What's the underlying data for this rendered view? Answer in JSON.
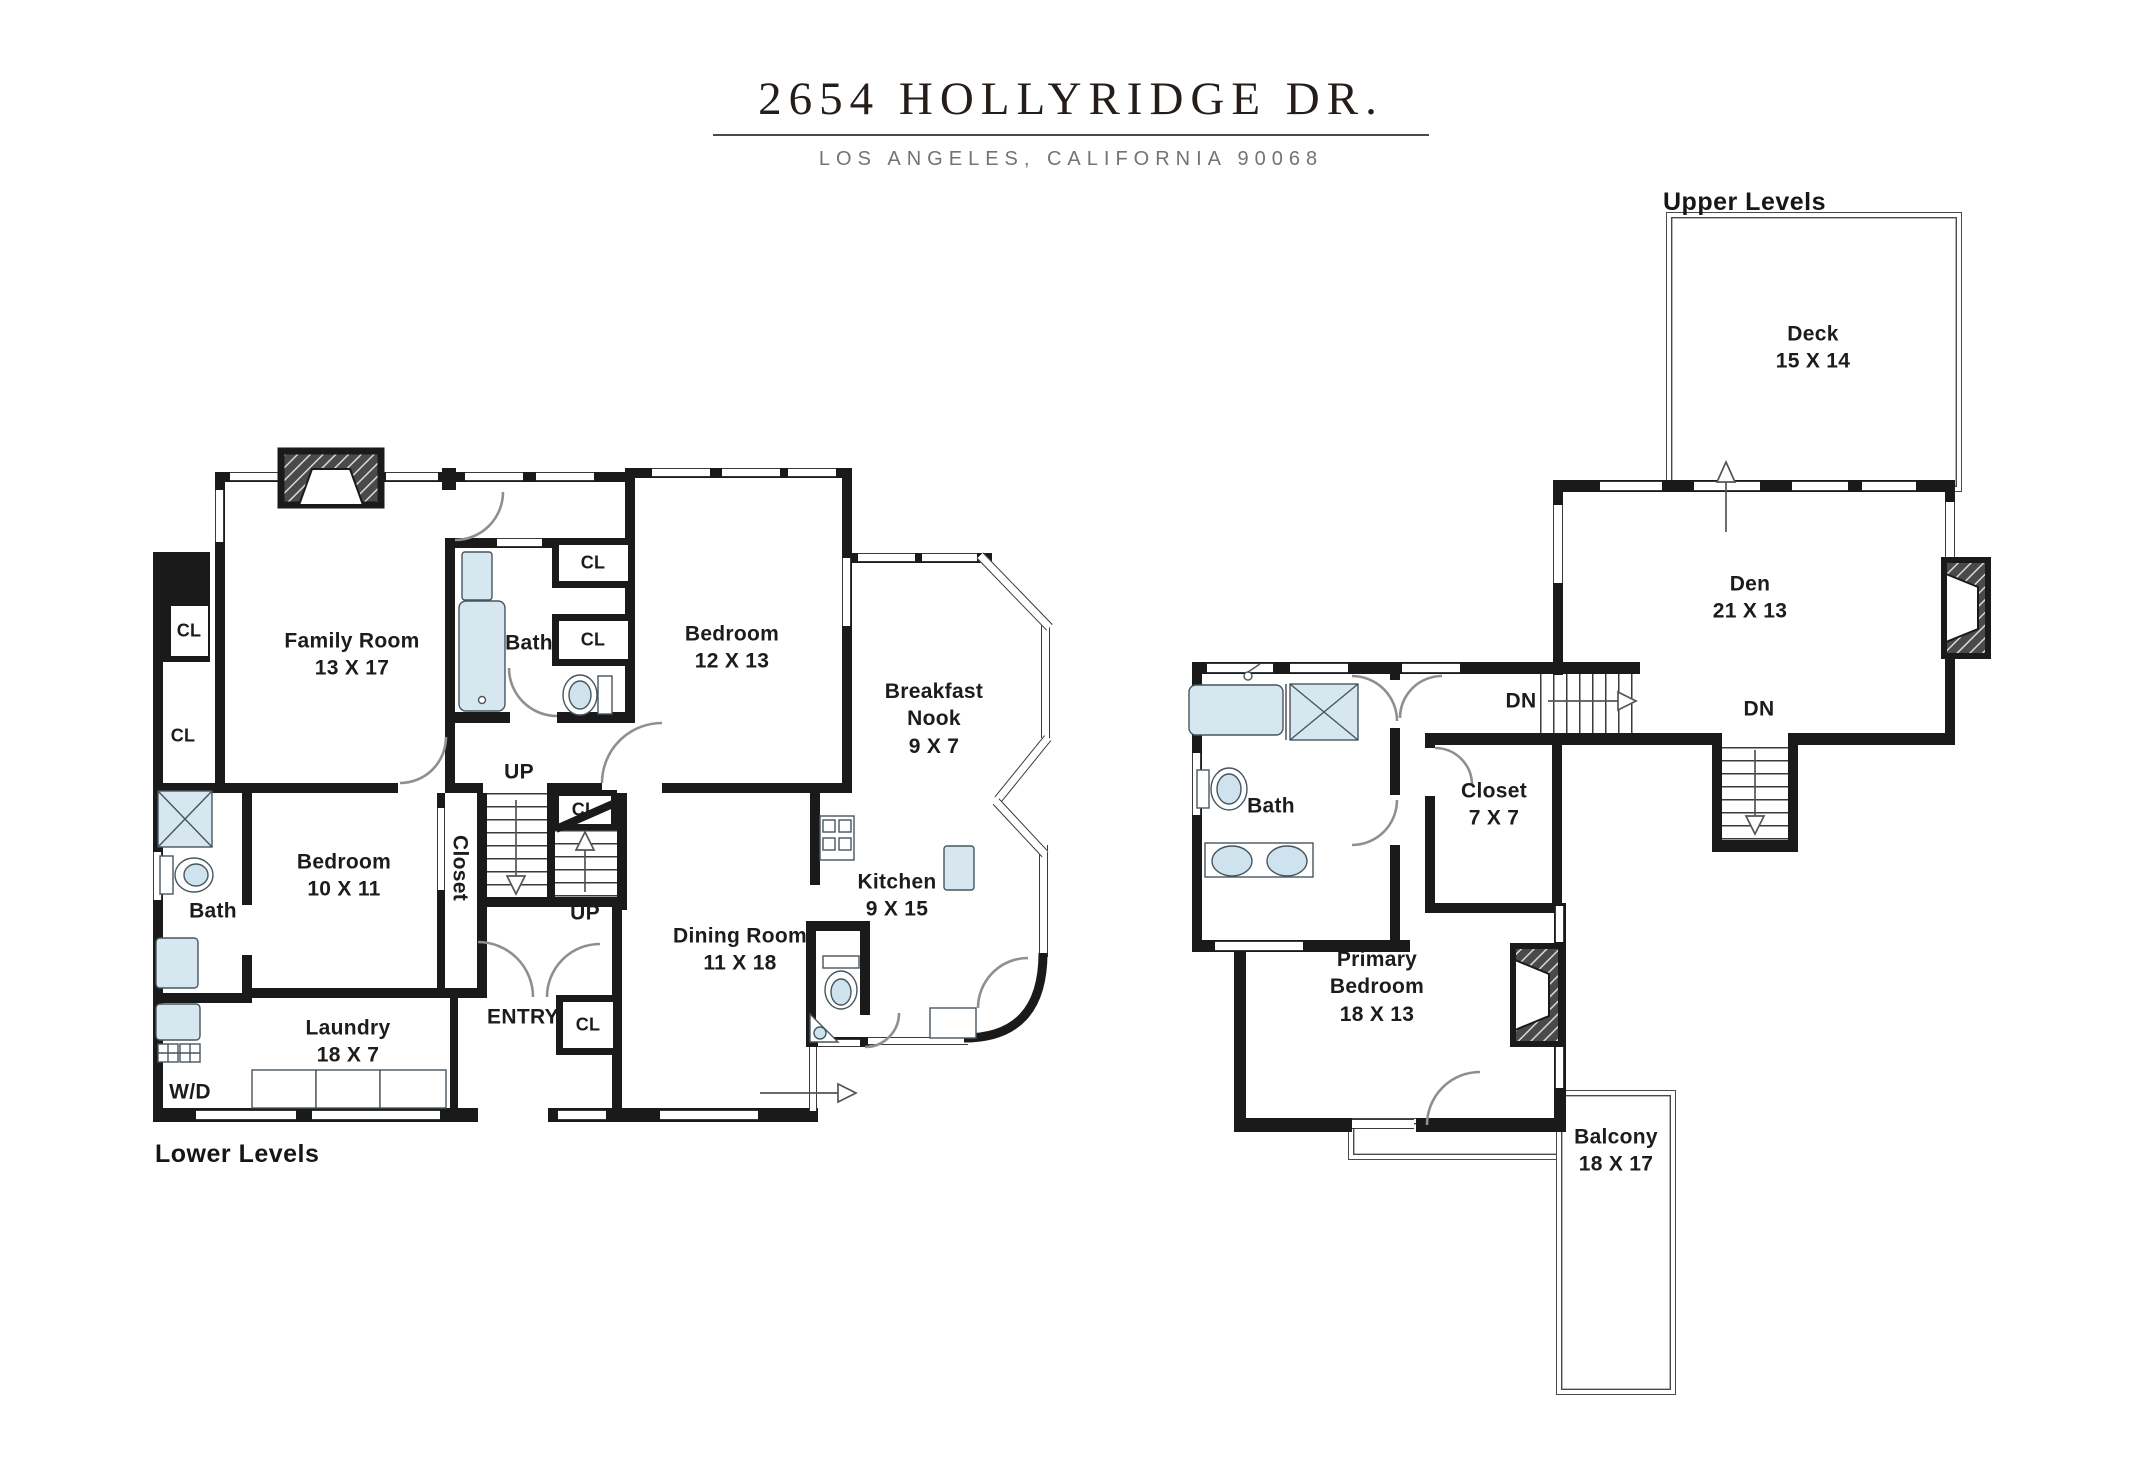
{
  "header": {
    "title": "2654 HOLLYRIDGE  DR.",
    "subtitle": "LOS ANGELES, CALIFORNIA  90068"
  },
  "plans": {
    "lower": {
      "caption": "Lower Levels",
      "rooms": {
        "family_room": "Family Room\n13 X 17",
        "bath_upper": "Bath",
        "bedroom_12x13": "Bedroom\n12 X 13",
        "breakfast_nook": "Breakfast\nNook\n9 X 7",
        "kitchen": "Kitchen\n9 X 15",
        "dining_room": "Dining Room\n11 X 18",
        "bedroom_10x11": "Bedroom\n10 X 11",
        "closet_vertical": "Closet",
        "bath_lower": "Bath",
        "laundry": "Laundry\n18 X 7",
        "washer_dryer": "W/D",
        "entry": "ENTRY"
      },
      "closet_labels": [
        "CL",
        "CL",
        "CL",
        "CL",
        "CL",
        "CL"
      ],
      "stair_labels": {
        "up_left": "UP",
        "up_right": "UP"
      }
    },
    "upper": {
      "caption": "Upper Levels",
      "rooms": {
        "deck": "Deck\n15 X 14",
        "den": "Den\n21 X 13",
        "closet_7x7": "Closet\n7 X 7",
        "bath": "Bath",
        "primary_bedroom": "Primary\nBedroom\n18 X 13",
        "balcony": "Balcony\n18 X 17"
      },
      "stair_labels": {
        "dn_left": "DN",
        "dn_center": "DN"
      }
    }
  }
}
